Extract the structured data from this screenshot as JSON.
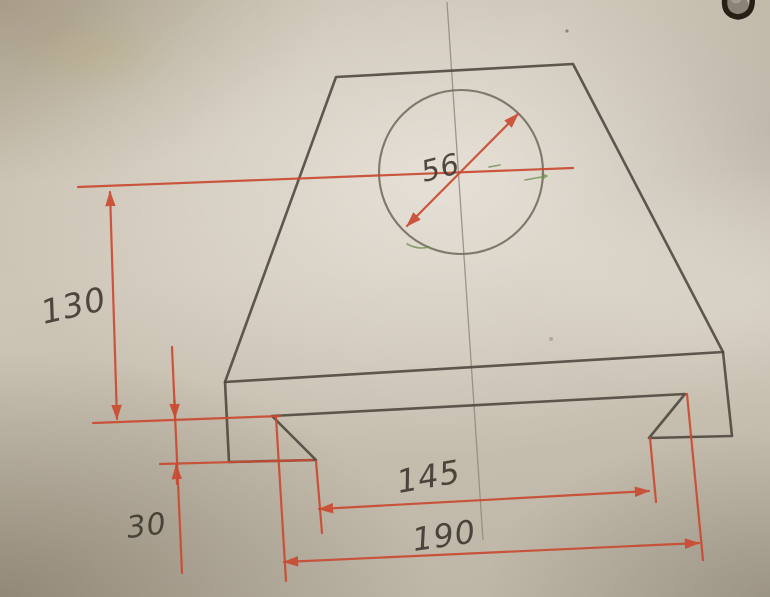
{
  "image": {
    "description": "Photograph of a hand-drawn engineering sketch: front view of a trapezoidal block with a central through-hole and a dovetail groove in its base",
    "medium": "pencil outline with red marker dimension lines on paper"
  },
  "dimensions": {
    "hole_diameter": "56",
    "center_height": "130",
    "groove_depth": "30",
    "groove_width_bottom": "145",
    "groove_width_top": "190"
  },
  "colors": {
    "dimension_red": "#c94a31",
    "pencil_dark": "#4b453c",
    "pencil_light": "#6e6759",
    "centerline_gray": "#8f897d",
    "annotation_green": "#6a8c4a",
    "paper": "#c8c0b1"
  }
}
